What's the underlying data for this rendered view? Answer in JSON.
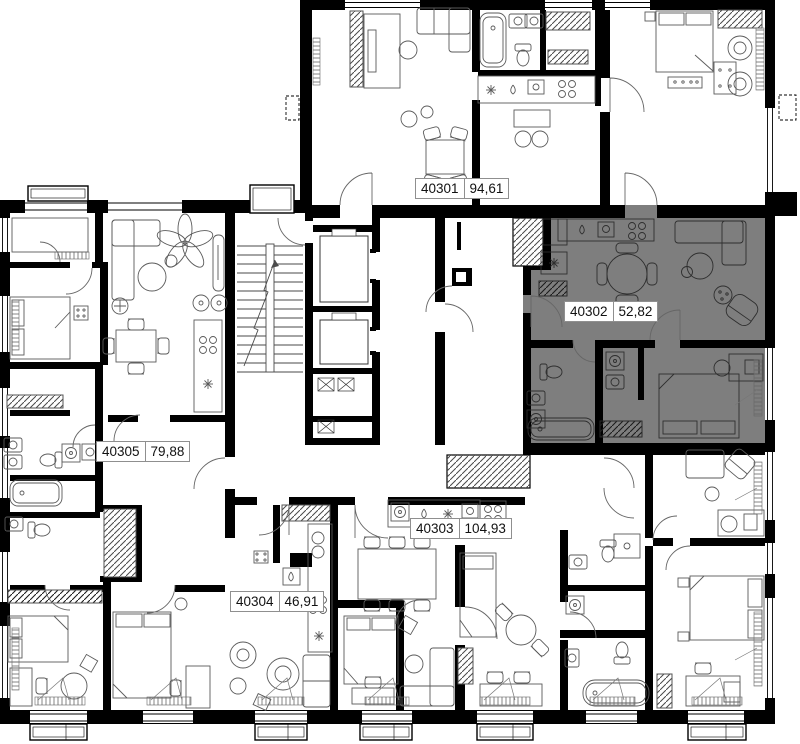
{
  "floorplan": {
    "units": [
      {
        "number": "40301",
        "area": "94,61",
        "highlighted": false
      },
      {
        "number": "40302",
        "area": "52,82",
        "highlighted": true
      },
      {
        "number": "40303",
        "area": "104,93",
        "highlighted": false
      },
      {
        "number": "40304",
        "area": "46,91",
        "highlighted": false
      },
      {
        "number": "40305",
        "area": "79,88",
        "highlighted": false
      }
    ],
    "colors": {
      "highlight_fill": "#7e7e7e",
      "wall": "#000000",
      "background": "#ffffff",
      "furniture_line": "#5a5a5a",
      "label_border": "#8f8f8f",
      "label_background": "#ffffff",
      "label_text": "#111111"
    }
  }
}
